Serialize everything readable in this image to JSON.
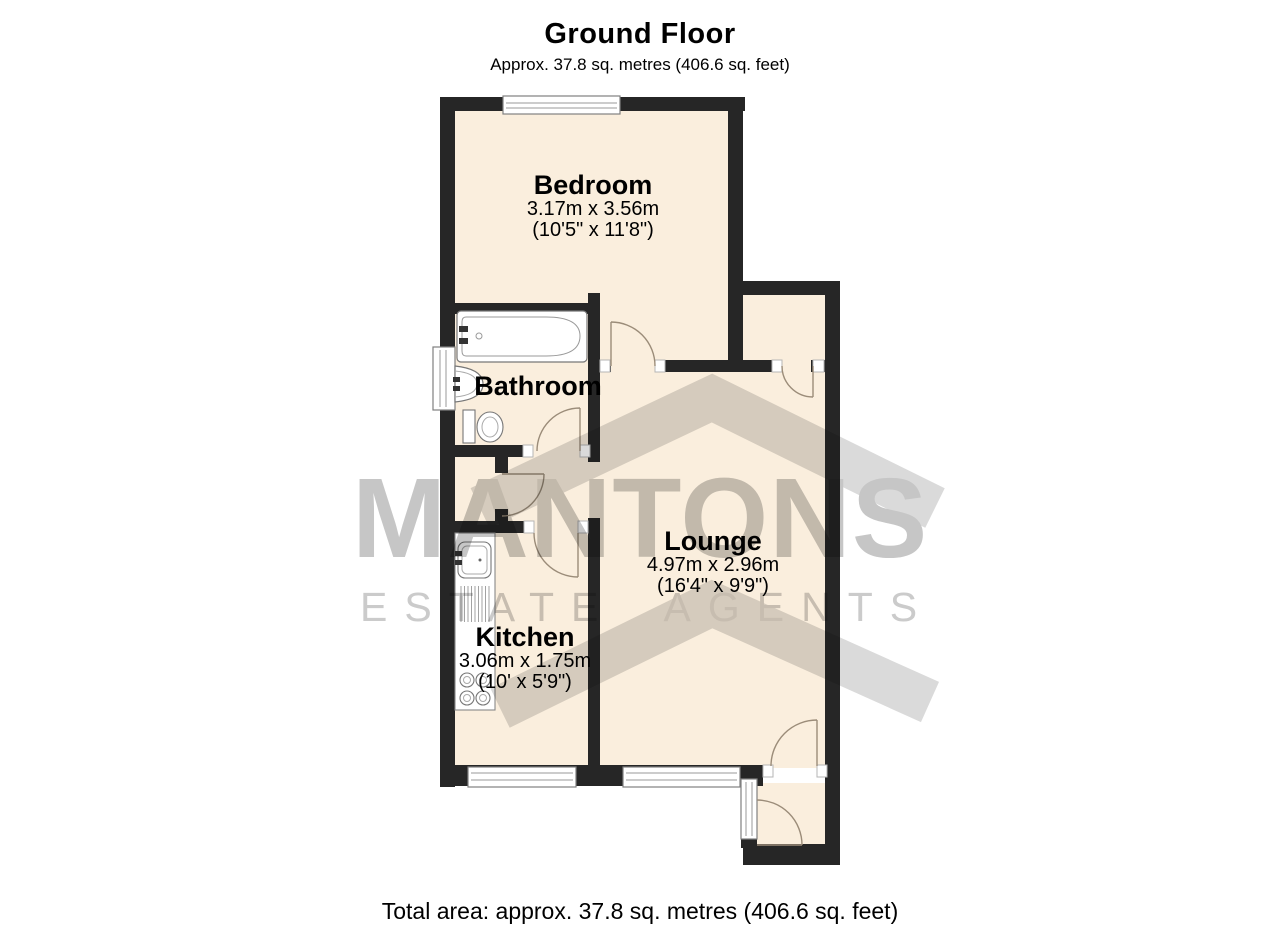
{
  "header": {
    "title": "Ground Floor",
    "subtitle": "Approx. 37.8 sq. metres (406.6 sq. feet)"
  },
  "rooms": {
    "bedroom": {
      "name": "Bedroom",
      "metric": "3.17m x 3.56m",
      "imperial": "(10'5\" x 11'8\")"
    },
    "bathroom": {
      "name": "Bathroom"
    },
    "lounge": {
      "name": "Lounge",
      "metric": "4.97m x 2.96m",
      "imperial": "(16'4\" x 9'9\")"
    },
    "kitchen": {
      "name": "Kitchen",
      "metric": "3.06m x 1.75m",
      "imperial": "(10' x 5'9\")"
    }
  },
  "watermark": {
    "line1": "MANTONS",
    "line2": "ESTATE AGENTS"
  },
  "footer": {
    "total_area": "Total area: approx. 37.8 sq. metres (406.6 sq. feet)"
  },
  "colors": {
    "wall": "#262626",
    "floor": "#faeedd",
    "watermark_text": "#c6c6c6",
    "door_arc": "#9b8c79"
  }
}
